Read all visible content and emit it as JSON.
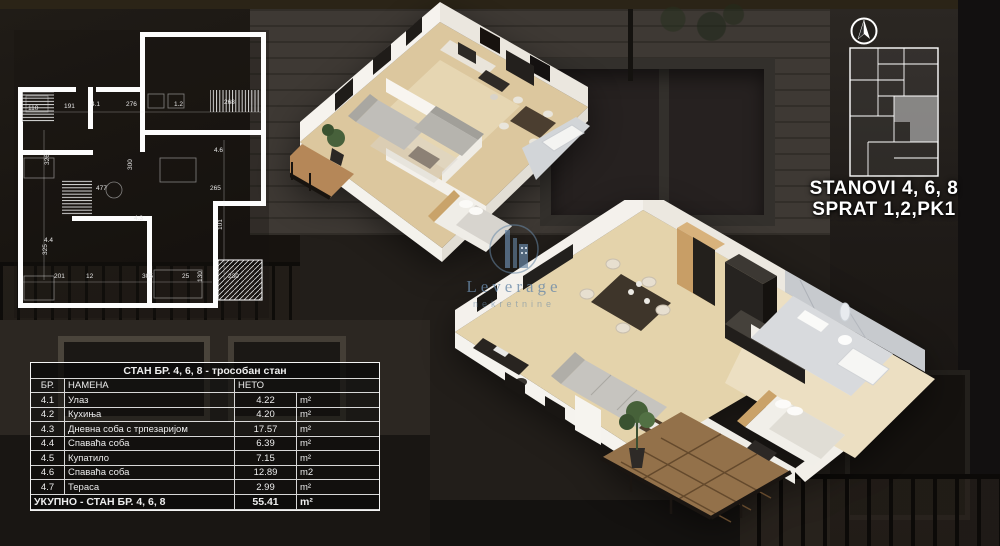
{
  "unit_info": {
    "line1": "STANOVI 4, 6, 8",
    "line2": "SPRAT 1,2,PK1"
  },
  "watermark": {
    "name": "Leverage",
    "subtitle": "nekretnine"
  },
  "plan_table": {
    "title": "СТАН БР. 4, 6, 8 - трособан стан",
    "columns": {
      "num": "БР.",
      "name": "НАМЕНА",
      "area": "НЕТО"
    },
    "rows": [
      {
        "num": "4.1",
        "name": "Улаз",
        "area": "4.22",
        "unit": "m²"
      },
      {
        "num": "4.2",
        "name": "Кухиња",
        "area": "4.20",
        "unit": "m²"
      },
      {
        "num": "4.3",
        "name": "Дневна соба с трпезаријом",
        "area": "17.57",
        "unit": "m²"
      },
      {
        "num": "4.4",
        "name": "Спаваћа соба",
        "area": "6.39",
        "unit": "m²"
      },
      {
        "num": "4.5",
        "name": "Купатило",
        "area": "7.15",
        "unit": "m²"
      },
      {
        "num": "4.6",
        "name": "Спаваћа соба",
        "area": "12.89",
        "unit": "m2"
      },
      {
        "num": "4.7",
        "name": "Тераса",
        "area": "2.99",
        "unit": "m²"
      }
    ],
    "total": {
      "label": "УКУПНО - СТАН БР. 4, 6, 8",
      "area": "55.41",
      "unit": "m²"
    }
  },
  "tech_plan": {
    "dims": [
      "110",
      "191",
      "4.1",
      "276",
      "1.2",
      "268",
      "477",
      "4.3",
      "4.6",
      "265",
      "300",
      "201",
      "12",
      "305",
      "25",
      "230",
      "326",
      "325",
      "101",
      "130",
      "4.4"
    ]
  },
  "icons": {
    "north": "north-arrow-icon",
    "logo": "building-logo-icon"
  },
  "colors": {
    "label_text": "#ffffff",
    "table_border": "#f2f2f2",
    "watermark_blue": "#6888a8",
    "plan_lines": "#ffffff",
    "mini_plan_highlight": "#bdbdbd",
    "render_wall": "#f4f1ec",
    "render_floor_wood": "#dcc79e",
    "render_marble": "#d3d6d8"
  }
}
